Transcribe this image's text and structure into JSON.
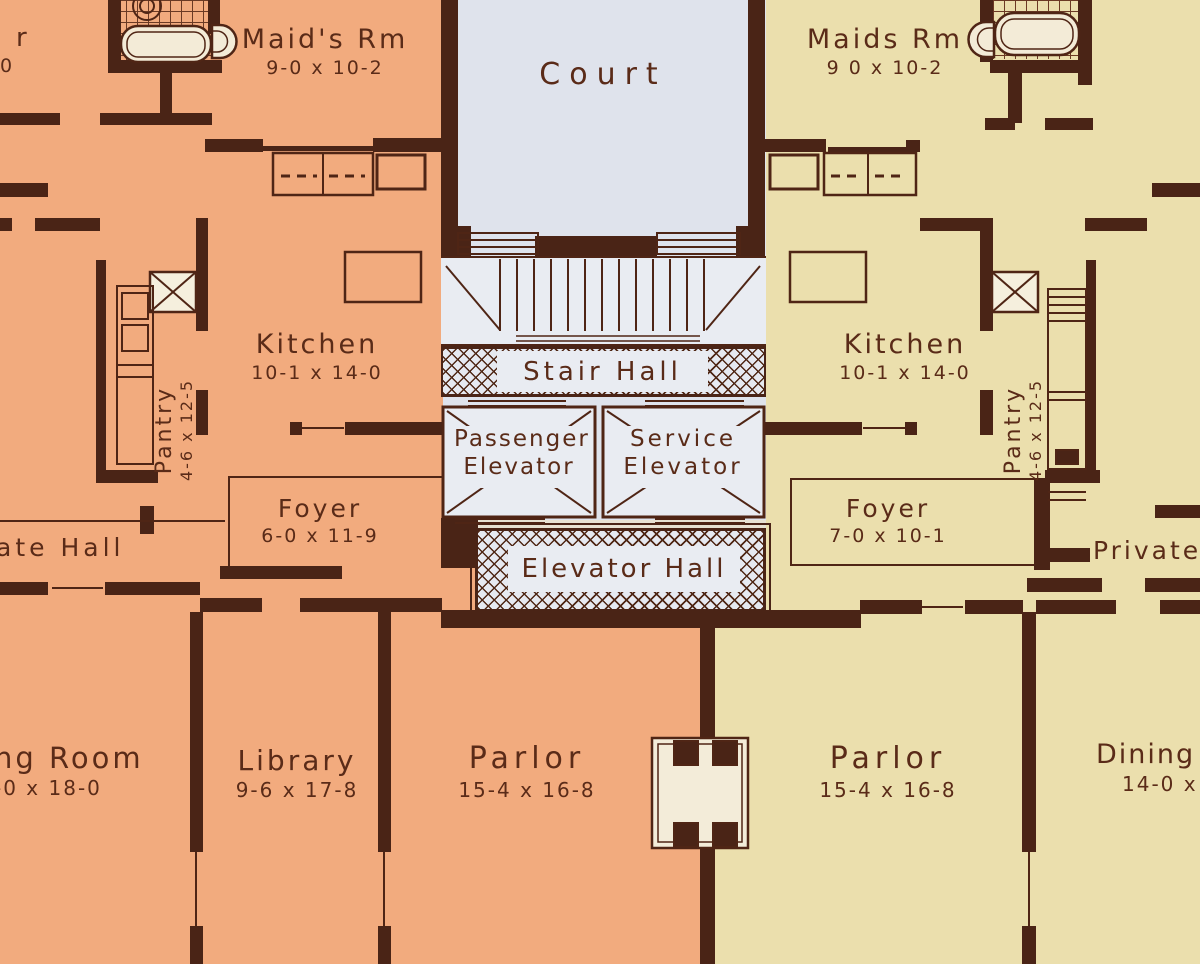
{
  "plan": {
    "kind": "apartment floor plan"
  },
  "colors": {
    "left_unit": "#f2ab7e",
    "right_unit": "#ebdfad",
    "hall_blue": "#dfe3ec",
    "wall_brown": "#4a2416",
    "ink_brown": "#5a2b18"
  },
  "labels": {
    "clipped_room_top_left": {
      "name": "r",
      "dims": "0"
    },
    "maids_rm_left": {
      "name": "Maid's Rm",
      "dims": "9-0 x 10-2"
    },
    "court": {
      "name": "Court"
    },
    "maids_rm_right": {
      "name": "Maids Rm",
      "dims": "9 0 x 10-2"
    },
    "kitchen_left": {
      "name": "Kitchen",
      "dims": "10-1 x 14-0"
    },
    "kitchen_right": {
      "name": "Kitchen",
      "dims": "10-1 x 14-0"
    },
    "pantry_left": {
      "name": "Pantry",
      "dims": "4-6 x 12-5"
    },
    "pantry_right": {
      "name": "Pantry",
      "dims": "4-6 x 12-5"
    },
    "stair_hall": {
      "name": "Stair Hall"
    },
    "passenger_elevator": {
      "line1": "Passenger",
      "line2": "Elevator"
    },
    "service_elevator": {
      "line1": "Service",
      "line2": "Elevator"
    },
    "elevator_hall": {
      "name": "Elevator Hall"
    },
    "foyer_left": {
      "name": "Foyer",
      "dims": "6-0 x 11-9"
    },
    "foyer_right": {
      "name": "Foyer",
      "dims": "7-0 x 10-1"
    },
    "private_hall_left_clipped": {
      "name": "ate Hall"
    },
    "private_hall_right": {
      "name": "Private"
    },
    "dining_room_left_clipped": {
      "name": "ng Room",
      "dims": "-0 x 18-0"
    },
    "library": {
      "name": "Library",
      "dims": "9-6 x 17-8"
    },
    "parlor_left": {
      "name": "Parlor",
      "dims": "15-4 x 16-8"
    },
    "parlor_right": {
      "name": "Parlor",
      "dims": "15-4 x 16-8"
    },
    "dining_room_right_clipped": {
      "name": "Dining",
      "dims": "14-0 x"
    }
  }
}
